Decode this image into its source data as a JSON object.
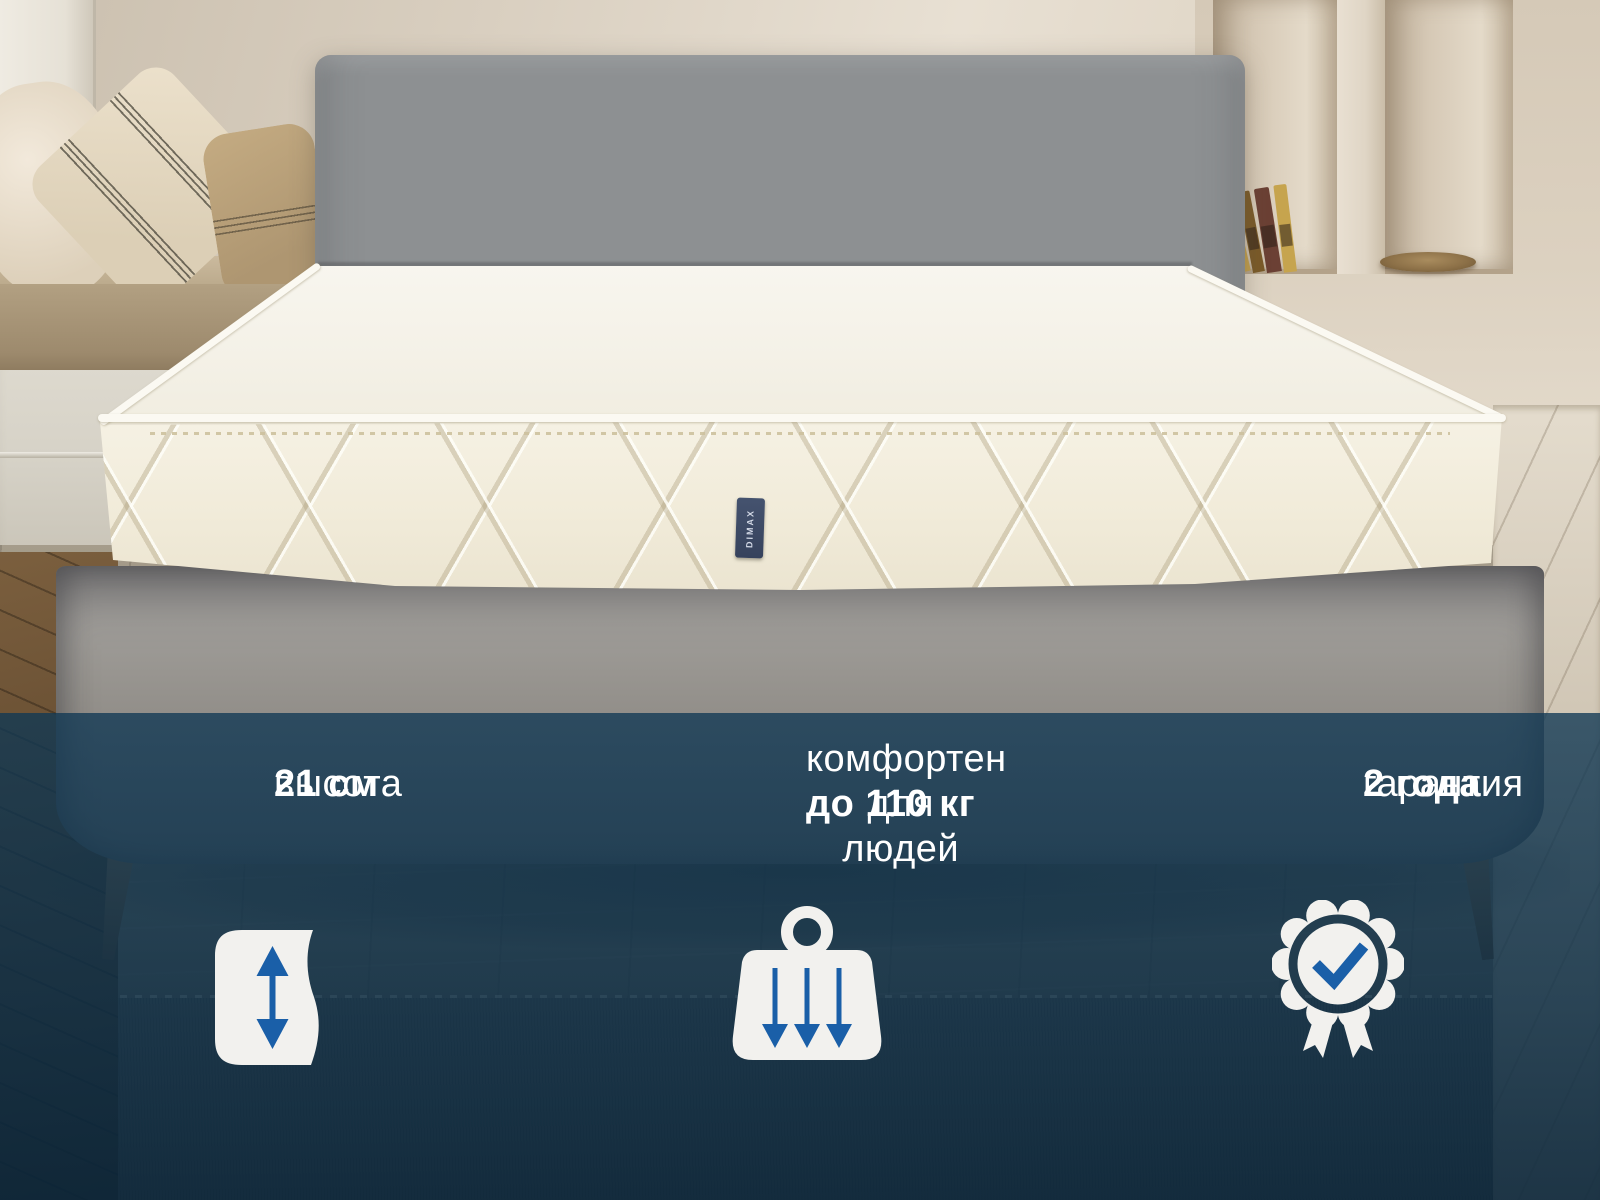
{
  "scene": {
    "description": "White quilted mattress on a grey upholstered bed in a beige bedroom, dark blue feature banner across the bottom",
    "wall_color": "#ddd2c2",
    "headboard_color": "#8e9294",
    "mattress_color": "#f4f0e3",
    "floor_color": "#8c8270"
  },
  "mattress": {
    "brand_label": "DIMAX"
  },
  "banner": {
    "bg_color": "#0d3350",
    "text_color": "#ffffff",
    "icon_blue": "#1a5fa8",
    "icon_white": "#f2f1ee",
    "features": [
      {
        "id": "height",
        "regular": "высота",
        "bold": "21 см",
        "icon": "height-range-icon"
      },
      {
        "id": "comfort",
        "line1": "комфортен",
        "line2_regular": "для людей",
        "line2_bold": "до 110 кг",
        "icon": "weight-load-icon"
      },
      {
        "id": "warranty",
        "regular": "гарантия",
        "bold": "2 года",
        "icon": "warranty-badge-icon"
      }
    ]
  }
}
